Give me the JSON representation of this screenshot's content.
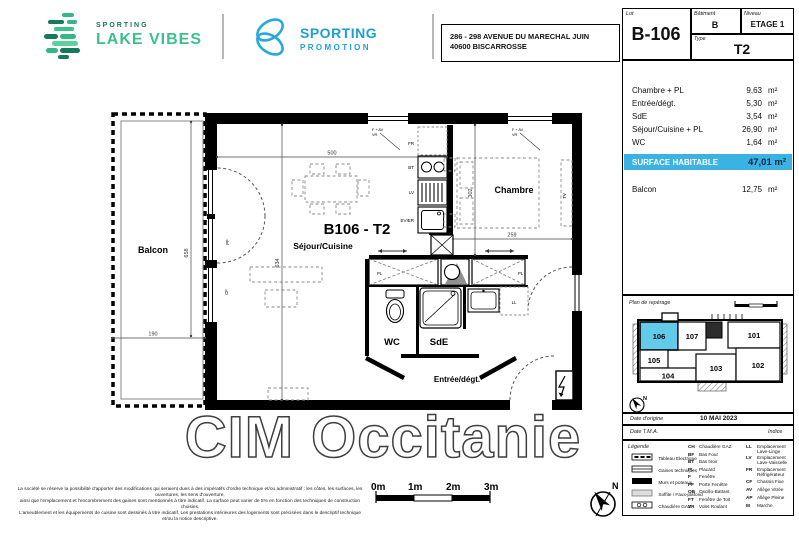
{
  "colors": {
    "brand_green": "#3cc08e",
    "brand_green_dark": "#157a5b",
    "brand_blue": "#1f9ed6",
    "highlight_cyan": "#3ab3e2",
    "miniplan_cyan": "#63cbea"
  },
  "header": {
    "brand1_line1": "SPORTING",
    "brand1_line2": "LAKE VIBES",
    "brand2_line1": "SPORTING",
    "brand2_line2": "PROMOTION",
    "address_line1": "286 - 298 AVENUE DU MARECHAL JUIN",
    "address_line2": "40600 BISCARROSSE"
  },
  "lot": {
    "lot_label": "Lot",
    "lot_value": "B-106",
    "batiment_label": "Bâtiment",
    "batiment_value": "B",
    "niveau_label": "Niveau",
    "niveau_value": "ETAGE 1",
    "type_label": "Type",
    "type_value": "T2"
  },
  "areas": {
    "rows": [
      {
        "name": "Chambre + PL",
        "value": "9,63",
        "unit": "m²"
      },
      {
        "name": "Entrée/dégt.",
        "value": "5,30",
        "unit": "m²"
      },
      {
        "name": "SdE",
        "value": "3,54",
        "unit": "m²"
      },
      {
        "name": "Séjour/Cuisine + PL",
        "value": "26,90",
        "unit": "m²"
      },
      {
        "name": "WC",
        "value": "1,64",
        "unit": "m²"
      }
    ],
    "total_label": "SURFACE HABITABLE",
    "total_value": "47,01 m²",
    "balcon_name": "Balcon",
    "balcon_value": "12,75",
    "balcon_unit": "m²"
  },
  "plan": {
    "unit_title": "B106 - T2",
    "room_sejour": "Séjour/Cuisine",
    "room_balcon": "Balcon",
    "room_chambre": "Chambre",
    "room_wc": "WC",
    "room_sde": "SdE",
    "room_entree": "Entrée/dégt.",
    "dim_balcon_h": "658",
    "dim_balcon_w": "190",
    "dim_sejour_w": "500",
    "dim_sejour_h": "634",
    "dim_chambre_h": "302",
    "dim_chambre_w": "259",
    "lbl_fr": "FR",
    "lbl_bt": "BT",
    "lbl_lv": "LV",
    "lbl_evier": "EVIER",
    "lbl_pl_left": "PL",
    "lbl_pl_right": "PL",
    "lbl_ll": "LL",
    "lbl_tv": "TV",
    "lbl_pf": "PF",
    "lbl_cf": "CF",
    "window_label": "F + AV",
    "window_sub": "VR"
  },
  "watermark": "CIM Occitanie",
  "reperage": {
    "title": "Plan de repérage",
    "units": [
      "106",
      "107",
      "101",
      "105",
      "104",
      "103",
      "102"
    ]
  },
  "dates": {
    "origine_label": "Date d'origine",
    "origine_value": "10 MAI 2023",
    "tma_label": "Date T.M.A.",
    "indice_label": "Indice"
  },
  "legend": {
    "title": "Légende",
    "symbols": [
      "Tableau Electrique",
      "Gaines techniques",
      "Murs et poteaux",
      "Soffite / Faux-plafond",
      "Chaudière GAZ"
    ],
    "abbr1": [
      {
        "code": "CH",
        "label": "Chaudière GAZ"
      },
      {
        "code": "BF",
        "label": "Bas Four"
      },
      {
        "code": "BT",
        "label": "Bas tiroir"
      },
      {
        "code": "PL",
        "label": "Placard"
      },
      {
        "code": "F",
        "label": "Fenêtre"
      },
      {
        "code": "PF",
        "label": "Porte Fenêtre"
      },
      {
        "code": "OB",
        "label": "Oscillo-Battant"
      },
      {
        "code": "FT",
        "label": "Fenêtre de Toit"
      },
      {
        "code": "VR",
        "label": "Volet Roulant"
      }
    ],
    "abbr2": [
      {
        "code": "LL",
        "label": "Emplacement",
        "label2": "Lave-Linge"
      },
      {
        "code": "LV",
        "label": "Emplacement",
        "label2": "Lave-Vaisselle"
      },
      {
        "code": "FR",
        "label": "Emplacement",
        "label2": "Réfrigérateur"
      },
      {
        "code": "CF",
        "label": "Chassis Fixe",
        "label2": ""
      },
      {
        "code": "AV",
        "label": "Allège Vitrée",
        "label2": ""
      },
      {
        "code": "AP",
        "label": "Allège Pleine",
        "label2": ""
      },
      {
        "code": "M",
        "label": "Marche",
        "label2": ""
      }
    ]
  },
  "footer": {
    "disclaimer1": "La société se réserve la possibilité d'apporter des modifications qui seraient dues à des impératifs d'ordre technique et/ou administratif : les côtes, les surfaces, les ouvertures, les sens d'ouverture,",
    "disclaimer2": "ainsi que l'emplacement et l'encombrement des gaines sont mentionnés à titre indicatif. La surface peut varier de 5% en fonction des techniques de construction choisies.",
    "disclaimer3": "L'ameublement et les équipements de cuisine sont dessinés à titre indicatif. Les prestations intérieures des logements sont précisées dans le descriptif technique et/ou la notice descriptive.",
    "scale": [
      "0m",
      "1m",
      "2m",
      "3m"
    ]
  }
}
